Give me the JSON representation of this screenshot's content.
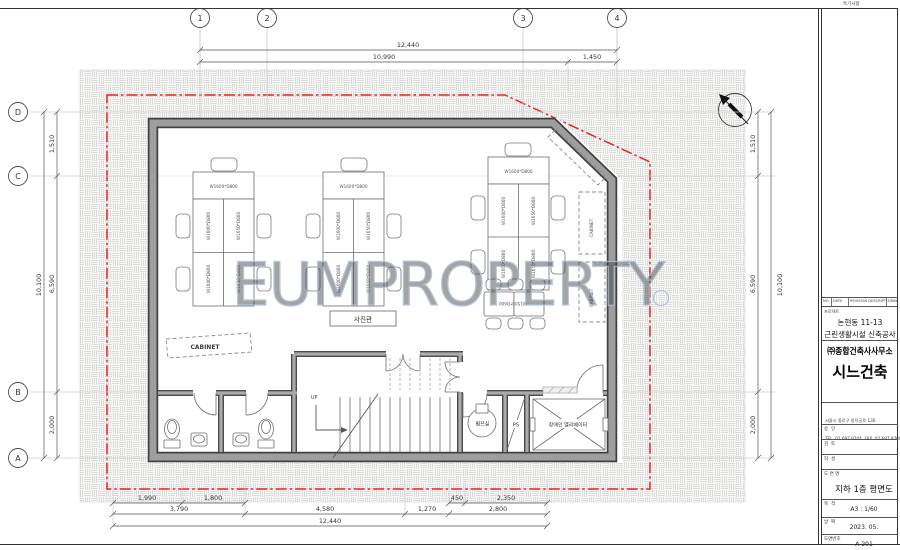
{
  "sheet": {
    "notes_label": "특기사항",
    "watermark": "EUMPROPERTY"
  },
  "grid": {
    "cols": [
      "1",
      "2",
      "3",
      "4"
    ],
    "rows": [
      "D",
      "C",
      "B",
      "A"
    ]
  },
  "dims": {
    "top": {
      "total": "12,440",
      "segs": [
        "10,990",
        "1,450"
      ]
    },
    "side": {
      "total": "10,100",
      "segs": [
        "1,510",
        "6,590",
        "2,000"
      ]
    },
    "bottom": {
      "row1": [
        "1,990",
        "1,800",
        "450",
        "2,350"
      ],
      "row2": [
        "3,790",
        "4,580",
        "1,270",
        "2,800"
      ],
      "total": "12,440"
    }
  },
  "plan": {
    "room_label": "사진관",
    "desk_h": "W1600*D800",
    "desk_v1": "W1600*D800",
    "desk_v2": "W1650*D800",
    "table_label": "W1500*D600",
    "cabinet": "CABINET",
    "up": "UP",
    "pump_room": "펌프실",
    "pipe_shaft": "PS",
    "elevator": "장애인 엘리베이터"
  },
  "titleblock": {
    "revision": {
      "no": "NO",
      "date": "DATE",
      "desc": "REVISION DESCRIPT",
      "drawn": "DRAWN"
    },
    "project_label": "프로젝트",
    "project_line1": "논현동 11-13",
    "project_line2": "근린생활시설 신축공사",
    "company": "㈜종합건축사사무소",
    "logo": "시느건축",
    "address1": "서울시 종로구 창덕궁로 136",
    "address2": "TEL. 02.697.9704  FAX. 02.697.9700",
    "approve_label": "승  인",
    "review_label": "검  토",
    "draft_label": "작  성",
    "drawing_label": "도 면 명",
    "drawing_name": "지하 1층 평면도",
    "scale_label": "축  척",
    "scale": "A3 : 1/60",
    "date_label": "날  짜",
    "date": "2023. 05.",
    "no_label": "도면번호",
    "number": "A-201"
  },
  "colors": {
    "boundary_red": "#e8251f",
    "wall_gray": "#9e9e9e",
    "watermark_blue": "#a9bcd8"
  }
}
